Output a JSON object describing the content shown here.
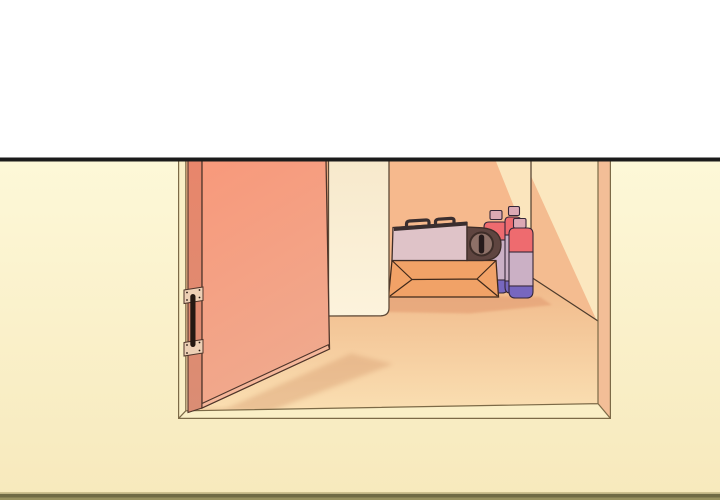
{
  "scene": {
    "kind": "comic-panel-illustration",
    "description": "White page band above a black panel line; below, an open salmon door reveals a closet containing a portable gas stove on a cardboard box beside three gas canisters.",
    "objects": {
      "door": "open-door",
      "hinge": "door-hinge",
      "frame": "doorway-frame",
      "panel": "leaning-white-panel",
      "box": "cardboard-box",
      "stove": "portable-gas-stove",
      "canister_count": 3
    },
    "colors": {
      "top_band": "#FFFFFF",
      "ink_line": "#1B1B1B",
      "bg_top": "#FDF8D8",
      "bg_bottom": "#F7E9BC",
      "bottom_border_light": "#CDC08F",
      "bottom_border_dark": "#6F6A45",
      "bottom_border_mid": "#97905F",
      "frame_fill": "#FAEFC6",
      "frame_line": "#7C6A47",
      "jamb_side": "#F3BE97",
      "door_top": "#F8997B",
      "door_bottom": "#F0A98D",
      "door_edge_top": "#E8866B",
      "door_edge_bottom": "#DA8D74",
      "door_bottom_face": "#F5B79A",
      "door_outline": "#4F352A",
      "hinge_plate": "#EDD0B5",
      "hinge_pin": "#241812",
      "panel_top": "#F7E9CC",
      "panel_bottom": "#FCF3DC",
      "panel_outline": "#5E4936",
      "back_wall": "#F6B98D",
      "wall_light": "#FBE5BD",
      "right_wall": "#FBE7BF",
      "wall_shade": "#F4BC90",
      "interior_line": "#4E3C2C",
      "floor_back": "#F0B788",
      "floor_front": "#FADFB2",
      "floor_shadow": "#D9A074",
      "box_face": "#F1A267",
      "box_line": "#40291A",
      "box_shadow": "#E5A176",
      "stove_body": "#DFC3C8",
      "stove_grate": "#3A2E2F",
      "stove_housing": "#5F4540",
      "stove_knob": "#8E7168",
      "stove_slot": "#261B1B",
      "stove_outline": "#3E2D28",
      "can_red": "#EE6B6F",
      "can_body": "#CBB0C5",
      "can_purple": "#7767BF",
      "can_cap": "#DCA9B4",
      "can_outline": "#342637"
    }
  }
}
